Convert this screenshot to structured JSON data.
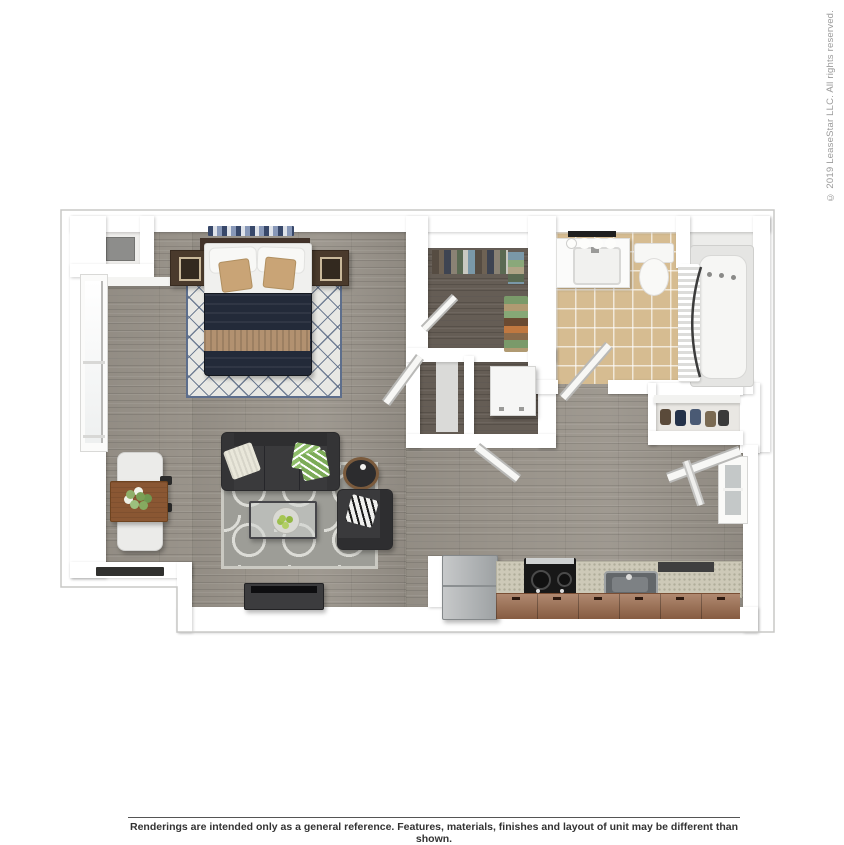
{
  "page": {
    "width": 844,
    "height": 844,
    "background": "#ffffff"
  },
  "sidebar": {
    "copyright": "© 2019 LeaseStar LLC. All rights reserved."
  },
  "footer": {
    "disclaimer": "Renderings are intended only as a general reference. Features, materials, finishes and layout of unit may be different than shown."
  },
  "floorplan": {
    "view": "3d-top-down-floor-plan-rendering",
    "unit": "studio-one-bath-apartment",
    "rooms": [
      "bedroom-living-area",
      "dining-nook",
      "walk-in-closet",
      "bathroom",
      "laundry-closet",
      "linen-closet",
      "entry-closet",
      "kitchen",
      "utility-niche"
    ],
    "furniture": [
      "queen-bed",
      "nightstand-left",
      "nightstand-right",
      "diamond-lattice-rug",
      "sofa",
      "coffee-table",
      "side-table",
      "armchair",
      "quatrefoil-rug",
      "tv-console",
      "dining-table",
      "dining-chairs",
      "refrigerator",
      "range",
      "kitchen-sink",
      "kitchen-cabinets",
      "vanity-sink",
      "vanity-lights",
      "toilet",
      "bathtub",
      "shower-curtain",
      "washer",
      "shoe-rack",
      "hanging-clothes"
    ],
    "colors": {
      "wall": "#ffffff",
      "outline": "#c8c8c6",
      "floor_wood": "#9a948b",
      "floor_wood_dark": "#655d55",
      "bath_tile": "#d6bc91",
      "duvet_navy": "#232a39",
      "accent_tan": "#c9a476",
      "charcoal": "#3a3a3c",
      "cabinet_brown": "#9c6b4c",
      "counter": "#cdc9b8",
      "rug_living": "#9d9d97",
      "rug_bed": "#e8e8e4",
      "text_dark": "#333333",
      "text_gray": "#9a9a9a",
      "rule": "#555555"
    }
  }
}
